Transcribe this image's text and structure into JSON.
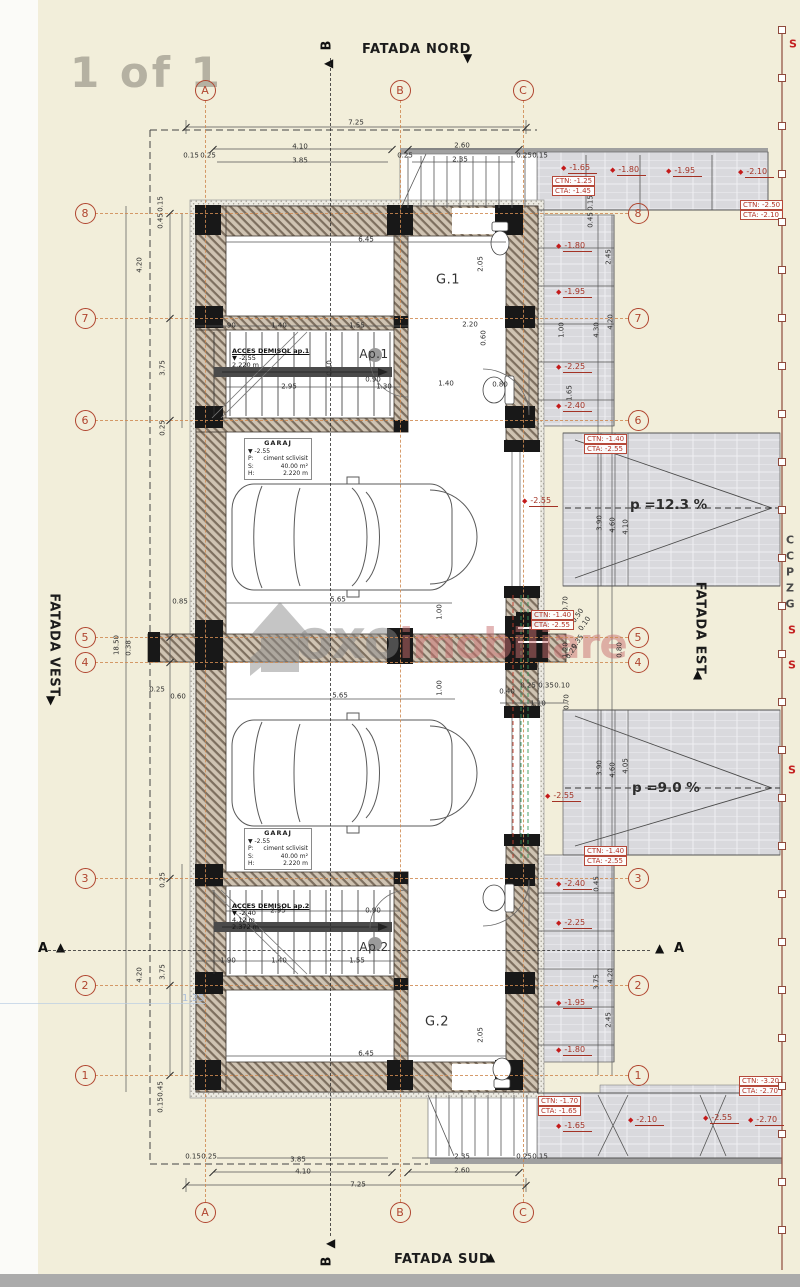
{
  "page": {
    "sheet_label": "1 of 1",
    "scale_note": "1:35"
  },
  "watermark": {
    "brand_gray": "oxo",
    "brand_red": "imobiliare"
  },
  "facades": {
    "north": "FATADA NORD",
    "south": "FATADA SUD",
    "east": "FATADA EST",
    "west": "FATADA VEST"
  },
  "section_markers": {
    "a": "A",
    "b": "B"
  },
  "grid": {
    "cols": [
      {
        "label": "A",
        "x": 205
      },
      {
        "label": "B",
        "x": 400
      },
      {
        "label": "C",
        "x": 523
      }
    ],
    "rows": [
      {
        "label": "8",
        "y": 213
      },
      {
        "label": "7",
        "y": 318
      },
      {
        "label": "6",
        "y": 420
      },
      {
        "label": "5",
        "y": 637
      },
      {
        "label": "4",
        "y": 662
      },
      {
        "label": "3",
        "y": 878
      },
      {
        "label": "2",
        "y": 985
      },
      {
        "label": "1",
        "y": 1075
      }
    ],
    "col_bubble_top_y": 90,
    "col_bubble_bottom_y": 1212,
    "row_bubble_left_x": 85,
    "row_bubble_right_x": 638
  },
  "rooms": {
    "g1": "G.1",
    "ap1": "Ap.1",
    "g2": "G.2",
    "ap2": "Ap.2"
  },
  "stair_labels": [
    {
      "title": "ACCES DEMISOL ap.1",
      "lines": [
        "▼ -2.55",
        "2.220 m"
      ],
      "x": 232,
      "y": 348
    },
    {
      "title": "ACCES DEMISOL ap.2",
      "lines": [
        "▼ -2.40",
        "4.12 m",
        "2.372 m"
      ],
      "x": 232,
      "y": 903
    }
  ],
  "garage_boxes": [
    {
      "title": "GARAJ",
      "level": "▼ -2.55",
      "rows": [
        [
          "P:",
          "ciment sclivisit"
        ],
        [
          "S:",
          "40.00 m²"
        ],
        [
          "H:",
          "2.220 m"
        ]
      ],
      "x": 244,
      "y": 438
    },
    {
      "title": "GARAJ",
      "level": "▼ -2.55",
      "rows": [
        [
          "P:",
          "ciment sclivisit"
        ],
        [
          "S:",
          "40.00 m²"
        ],
        [
          "H:",
          "2.220 m"
        ]
      ],
      "x": 244,
      "y": 828
    }
  ],
  "slopes": [
    {
      "text": "p =12.3 %",
      "x": 630,
      "y": 505
    },
    {
      "text": "p =9.0 %",
      "x": 632,
      "y": 788
    }
  ],
  "level_boxes": [
    {
      "ctn": "CTN: -1.25",
      "cta": "CTA: -1.45",
      "x": 552,
      "y": 176
    },
    {
      "ctn": "CTN: -2.50",
      "cta": "CTA: -2.10",
      "x": 740,
      "y": 200
    },
    {
      "ctn": "CTN: -1.40",
      "cta": "CTA: -2.55",
      "x": 584,
      "y": 434
    },
    {
      "ctn": "CTN: -1.40",
      "cta": "CTA: -2.55",
      "x": 531,
      "y": 610
    },
    {
      "ctn": "CTN: -1.40",
      "cta": "CTA: -2.55",
      "x": 584,
      "y": 846
    },
    {
      "ctn": "CTN: -1.70",
      "cta": "CTA: -1.65",
      "x": 538,
      "y": 1096
    },
    {
      "ctn": "CTN: -3.20",
      "cta": "CTA: -2.70",
      "x": 739,
      "y": 1076
    }
  ],
  "elevation_markers": [
    {
      "v": "-1.65",
      "x": 561,
      "y": 168
    },
    {
      "v": "-1.80",
      "x": 610,
      "y": 170
    },
    {
      "v": "-1.95",
      "x": 666,
      "y": 171
    },
    {
      "v": "-2.10",
      "x": 738,
      "y": 172
    },
    {
      "v": "-1.80",
      "x": 556,
      "y": 246
    },
    {
      "v": "-1.95",
      "x": 556,
      "y": 292
    },
    {
      "v": "-2.25",
      "x": 556,
      "y": 367
    },
    {
      "v": "-2.40",
      "x": 556,
      "y": 406
    },
    {
      "v": "-2.55",
      "x": 522,
      "y": 501
    },
    {
      "v": "-2.55",
      "x": 545,
      "y": 796
    },
    {
      "v": "-2.40",
      "x": 556,
      "y": 884
    },
    {
      "v": "-2.25",
      "x": 556,
      "y": 923
    },
    {
      "v": "-1.95",
      "x": 556,
      "y": 1003
    },
    {
      "v": "-1.80",
      "x": 556,
      "y": 1050
    },
    {
      "v": "-1.65",
      "x": 556,
      "y": 1126
    },
    {
      "v": "-2.10",
      "x": 628,
      "y": 1120
    },
    {
      "v": "-2.55",
      "x": 703,
      "y": 1118
    },
    {
      "v": "-2.70",
      "x": 748,
      "y": 1120
    }
  ],
  "dim_labels": [
    {
      "t": "7.25",
      "x": 356,
      "y": 123
    },
    {
      "t": "4.10",
      "x": 300,
      "y": 147
    },
    {
      "t": "3.85",
      "x": 300,
      "y": 161
    },
    {
      "t": "0.15",
      "x": 191,
      "y": 156
    },
    {
      "t": "0.25",
      "x": 208,
      "y": 156
    },
    {
      "t": "0.25",
      "x": 405,
      "y": 156
    },
    {
      "t": "2.60",
      "x": 462,
      "y": 146
    },
    {
      "t": "2.35",
      "x": 460,
      "y": 160
    },
    {
      "t": "0.25",
      "x": 524,
      "y": 156
    },
    {
      "t": "0.15",
      "x": 540,
      "y": 156
    },
    {
      "t": "6.45",
      "x": 366,
      "y": 240
    },
    {
      "t": "0.15",
      "x": 161,
      "y": 204,
      "r": -90
    },
    {
      "t": "0.45",
      "x": 161,
      "y": 221,
      "r": -90
    },
    {
      "t": "4.20",
      "x": 140,
      "y": 265,
      "r": -90
    },
    {
      "t": "3.75",
      "x": 163,
      "y": 368,
      "r": -90
    },
    {
      "t": "0.25",
      "x": 163,
      "y": 428,
      "r": -90
    },
    {
      "t": "18.50",
      "x": 117,
      "y": 645,
      "r": -90
    },
    {
      "t": "0.38",
      "x": 129,
      "y": 648,
      "r": -90
    },
    {
      "t": "0.85",
      "x": 180,
      "y": 602
    },
    {
      "t": "0.25",
      "x": 157,
      "y": 690
    },
    {
      "t": "0.60",
      "x": 178,
      "y": 697
    },
    {
      "t": "0.25",
      "x": 163,
      "y": 880,
      "r": -90
    },
    {
      "t": "3.75",
      "x": 163,
      "y": 972,
      "r": -90
    },
    {
      "t": "4.20",
      "x": 140,
      "y": 975,
      "r": -90
    },
    {
      "t": "0.45",
      "x": 161,
      "y": 1089,
      "r": -90
    },
    {
      "t": "0.15",
      "x": 161,
      "y": 1105,
      "r": -90
    },
    {
      "t": "1.90",
      "x": 228,
      "y": 326
    },
    {
      "t": "1.40",
      "x": 279,
      "y": 326
    },
    {
      "t": "1.55",
      "x": 357,
      "y": 326
    },
    {
      "t": "2.95",
      "x": 289,
      "y": 387
    },
    {
      "t": "1.30",
      "x": 384,
      "y": 387
    },
    {
      "t": "0.10",
      "x": 330,
      "y": 368,
      "r": -90
    },
    {
      "t": "2.05",
      "x": 481,
      "y": 264,
      "r": -90
    },
    {
      "t": "2.20",
      "x": 470,
      "y": 325
    },
    {
      "t": "0.60",
      "x": 484,
      "y": 338,
      "r": -90
    },
    {
      "t": "1.40",
      "x": 446,
      "y": 384
    },
    {
      "t": "0.80",
      "x": 500,
      "y": 385
    },
    {
      "t": "0.90",
      "x": 373,
      "y": 380
    },
    {
      "t": "5.65",
      "x": 338,
      "y": 600
    },
    {
      "t": "1.00",
      "x": 440,
      "y": 612,
      "r": -90
    },
    {
      "t": "5.65",
      "x": 340,
      "y": 696
    },
    {
      "t": "1.00",
      "x": 440,
      "y": 688,
      "r": -90
    },
    {
      "t": "0.70",
      "x": 566,
      "y": 604,
      "r": -90
    },
    {
      "t": "1.20",
      "x": 566,
      "y": 650,
      "r": -90
    },
    {
      "t": "0.50",
      "x": 578,
      "y": 616,
      "r": -55
    },
    {
      "t": "0.10",
      "x": 585,
      "y": 624,
      "r": -55
    },
    {
      "t": "0.35",
      "x": 578,
      "y": 642,
      "r": -55
    },
    {
      "t": "0.25",
      "x": 572,
      "y": 652,
      "r": -55
    },
    {
      "t": "0.80",
      "x": 620,
      "y": 650,
      "r": -90
    },
    {
      "t": "0.40",
      "x": 507,
      "y": 692
    },
    {
      "t": "0.25",
      "x": 528,
      "y": 686
    },
    {
      "t": "0.35",
      "x": 546,
      "y": 686
    },
    {
      "t": "0.10",
      "x": 562,
      "y": 686
    },
    {
      "t": "1.10",
      "x": 538,
      "y": 704
    },
    {
      "t": "0.70",
      "x": 567,
      "y": 702,
      "r": -90
    },
    {
      "t": "2.95",
      "x": 278,
      "y": 911
    },
    {
      "t": "0.90",
      "x": 373,
      "y": 911
    },
    {
      "t": "1.90",
      "x": 228,
      "y": 961
    },
    {
      "t": "1.40",
      "x": 279,
      "y": 961
    },
    {
      "t": "1.55",
      "x": 357,
      "y": 961
    },
    {
      "t": "6.45",
      "x": 366,
      "y": 1054
    },
    {
      "t": "2.05",
      "x": 481,
      "y": 1035,
      "r": -90
    },
    {
      "t": "0.15",
      "x": 591,
      "y": 203,
      "r": -90
    },
    {
      "t": "0.45",
      "x": 591,
      "y": 220,
      "r": -90
    },
    {
      "t": "2.45",
      "x": 609,
      "y": 257,
      "r": -90
    },
    {
      "t": "1.00",
      "x": 562,
      "y": 330,
      "r": -90
    },
    {
      "t": "1.65",
      "x": 570,
      "y": 393,
      "r": -90
    },
    {
      "t": "4.30",
      "x": 597,
      "y": 330,
      "r": -90
    },
    {
      "t": "4.20",
      "x": 611,
      "y": 322,
      "r": -90
    },
    {
      "t": "3.90",
      "x": 600,
      "y": 523,
      "r": -90
    },
    {
      "t": "4.60",
      "x": 613,
      "y": 525,
      "r": -90
    },
    {
      "t": "4.10",
      "x": 626,
      "y": 527,
      "r": -90
    },
    {
      "t": "3.90",
      "x": 600,
      "y": 768,
      "r": -90
    },
    {
      "t": "4.60",
      "x": 613,
      "y": 770,
      "r": -90
    },
    {
      "t": "4.05",
      "x": 626,
      "y": 766,
      "r": -90
    },
    {
      "t": "2.45",
      "x": 609,
      "y": 1020,
      "r": -90
    },
    {
      "t": "3.75",
      "x": 597,
      "y": 982,
      "r": -90
    },
    {
      "t": "4.20",
      "x": 611,
      "y": 976,
      "r": -90
    },
    {
      "t": "0.45",
      "x": 597,
      "y": 884,
      "r": -90
    },
    {
      "t": "0.15",
      "x": 193,
      "y": 1157
    },
    {
      "t": "0.25",
      "x": 209,
      "y": 1157
    },
    {
      "t": "3.85",
      "x": 298,
      "y": 1160
    },
    {
      "t": "4.10",
      "x": 303,
      "y": 1172
    },
    {
      "t": "2.35",
      "x": 462,
      "y": 1157
    },
    {
      "t": "2.60",
      "x": 462,
      "y": 1171
    },
    {
      "t": "7.25",
      "x": 358,
      "y": 1185
    },
    {
      "t": "0.25",
      "x": 524,
      "y": 1157
    },
    {
      "t": "0.15",
      "x": 540,
      "y": 1157
    }
  ],
  "edge_texts": [
    {
      "t": "S",
      "x": 793,
      "y": 44,
      "c": "red"
    },
    {
      "t": "C",
      "x": 790,
      "y": 540
    },
    {
      "t": "C",
      "x": 790,
      "y": 556
    },
    {
      "t": "P",
      "x": 790,
      "y": 572
    },
    {
      "t": "Z",
      "x": 790,
      "y": 588
    },
    {
      "t": "G",
      "x": 790,
      "y": 604
    },
    {
      "t": "S",
      "x": 792,
      "y": 630,
      "c": "red"
    },
    {
      "t": "S",
      "x": 792,
      "y": 665,
      "c": "red"
    },
    {
      "t": "S",
      "x": 792,
      "y": 770,
      "c": "red"
    }
  ],
  "fence": {
    "x": 782,
    "y1": 28,
    "y2": 1270,
    "step": 48
  },
  "colors": {
    "paper": "#f2eeda",
    "bubble": "#b0452f",
    "grid_line": "#cf8a52",
    "elevation_red": "#c41a1a",
    "wall_hatch": "#7d6f5f",
    "paving": "#d9d9dd",
    "watermark_gray": "#878787",
    "watermark_red": "#c96f6f",
    "scale_blue": "#9fb6d9"
  }
}
